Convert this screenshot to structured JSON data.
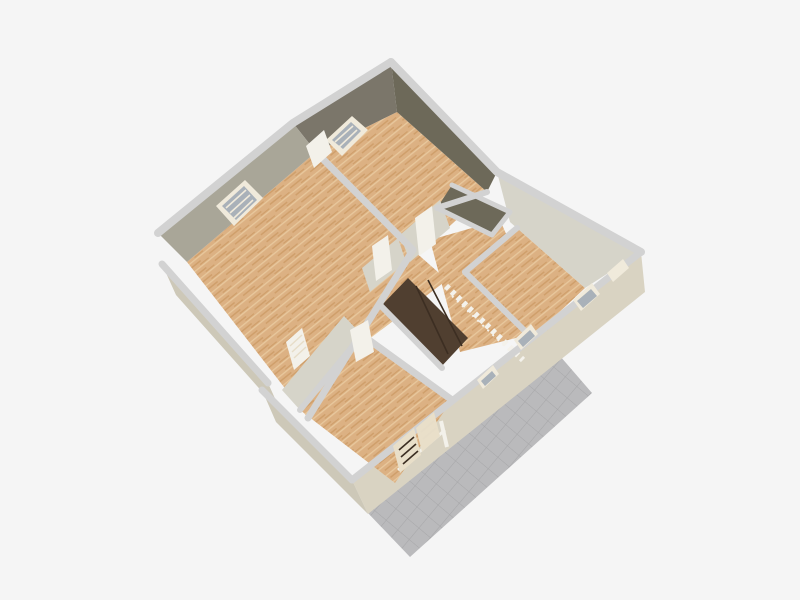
{
  "scene": {
    "type": "3d-floor-plan-aerial-render",
    "description": "Aerial 3D render of a single-storey home floor plan with wood parquet floors, open stairwell and tiled terrace",
    "rooms": [
      "top-room",
      "left-room",
      "right-room",
      "bottom-room",
      "hallway",
      "closet-alcove"
    ],
    "features": [
      "stairwell",
      "balustrade",
      "terrace",
      "french-louver-door"
    ],
    "windows": [
      "left-room-window",
      "top-room-window",
      "se-window-upper",
      "se-window-mid",
      "se-window-lower",
      "ne-corner-window"
    ],
    "doors": [
      "top-room-door",
      "hall-door-1",
      "hall-door-2",
      "bottom-room-open-door",
      "sw-small-door",
      "french-door"
    ]
  },
  "colors": {
    "background": "#f5f5f5",
    "wall_top": "#d2d2d2",
    "wall_exterior_se": "#d9d3c2",
    "wall_exterior_sw": "#cdc8b8",
    "wall_interior_light": "#d6d4c9",
    "wall_interior_medium": "#a9a698",
    "wall_interior_dark": "#7b766a",
    "wall_interior_darker": "#6d6959",
    "floor_wood": "#dcb183",
    "floor_streak_dark": "#cf9f6b",
    "floor_streak_light": "#e8c89d",
    "terrace_tile": "#bababc",
    "terrace_tile_line": "#a7a7a9",
    "stair_dark": "#503f30",
    "stair_line": "#3c2e22",
    "balustrade_white": "#f4f2ec",
    "door_white": "#f3f1ea",
    "door_frame": "#e7ddc8",
    "window_glass": "#a9b1b9",
    "window_frame": "#f0eadb",
    "louver_cream": "#e9dfc9"
  }
}
